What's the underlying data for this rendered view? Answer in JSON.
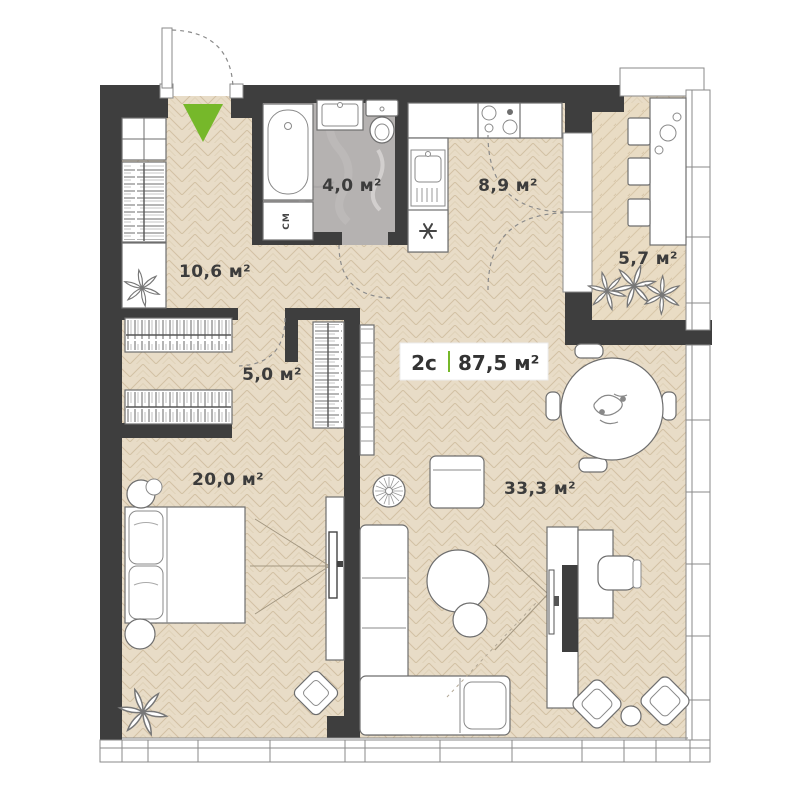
{
  "badge": {
    "type": "2с",
    "total_area": "87,5 м²"
  },
  "rooms": {
    "hallway": {
      "area": "10,6 м²"
    },
    "bathroom": {
      "area": "4,0 м²"
    },
    "kitchen": {
      "area": "8,9 м²"
    },
    "balcony": {
      "area": "5,7 м²"
    },
    "wardrobe": {
      "area": "5,0 м²"
    },
    "bedroom": {
      "area": "20,0 м²"
    },
    "living_room": {
      "area": "33,3 м²"
    }
  },
  "appliances": {
    "washing_machine": "СМ"
  },
  "icons": {
    "entrance_marker": "green-triangle-down",
    "fridge": "snowflake",
    "plants": "leaf-star"
  },
  "colors": {
    "wall": "#3e3e3e",
    "floor_parquet": "#e8dcc7",
    "floor_bathroom": "#b5b2b1",
    "accent_green": "#76b82a",
    "furniture_outline": "#6e6e6e"
  }
}
